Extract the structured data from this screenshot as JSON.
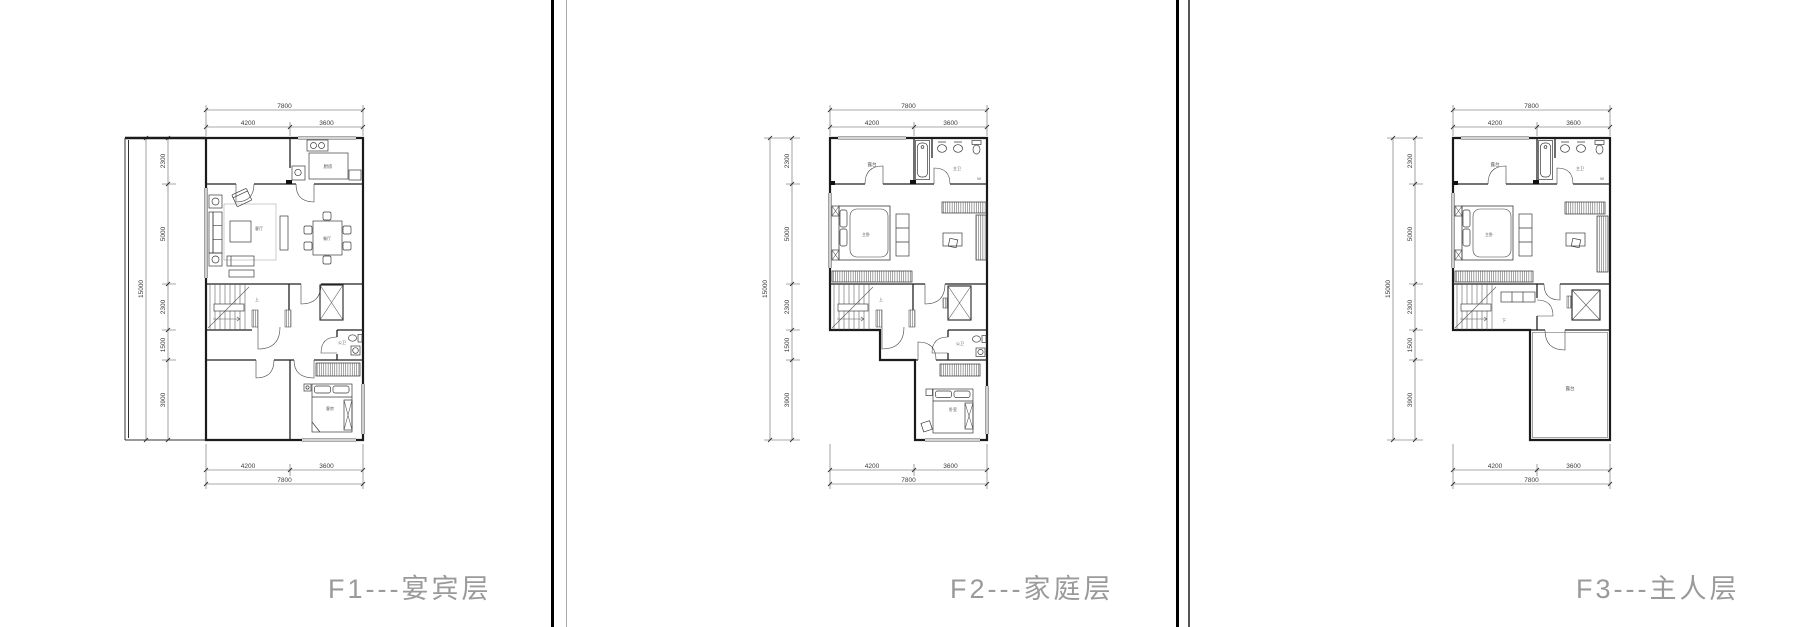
{
  "titles": {
    "f1": "F1---宴宾层",
    "f2": "F2---家庭层",
    "f3": "F3---主人层"
  },
  "dims": {
    "overall_width": "7800",
    "width_left": "4200",
    "width_right": "3600",
    "overall_height": "15000",
    "height_segments": [
      "2300",
      "5000",
      "2300",
      "1500",
      "3900"
    ]
  },
  "rooms": {
    "f1": {
      "kitchen": "厨房",
      "living": "客厅",
      "dining": "餐厅",
      "stair": "上",
      "bath": "公卫",
      "bedroom": "客房"
    },
    "f2": {
      "terrace": "露台",
      "master_bath": "主卫",
      "drain": "W",
      "master_bedroom": "主卧",
      "stair": "上",
      "bath": "公卫",
      "bedroom": "卧室"
    },
    "f3": {
      "terrace_top": "露台",
      "master_bath": "主卫",
      "drain": "W",
      "master_bedroom": "主卧",
      "stair": "下",
      "terrace": "露台"
    }
  },
  "colors": {
    "wall": "#1b1b1b",
    "title_gray": "#9a9a9a",
    "divider_black": "#000000"
  }
}
